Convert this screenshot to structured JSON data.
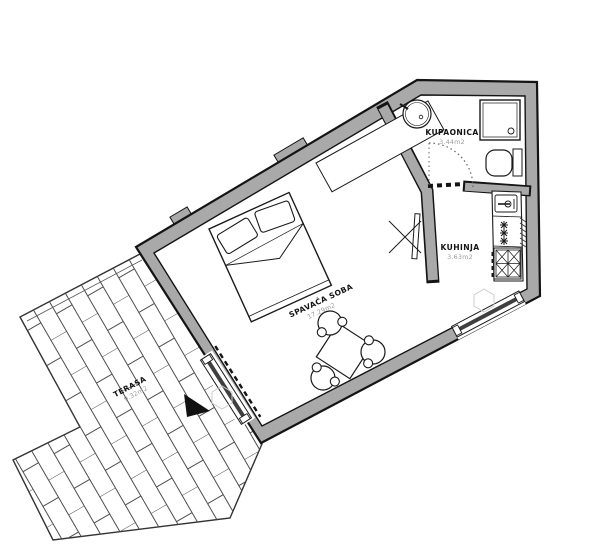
{
  "plan": {
    "rooms": [
      {
        "id": "kupaonica",
        "name": "KUPAONICA",
        "area": "3.44m2"
      },
      {
        "id": "kuhinja",
        "name": "KUHINJA",
        "area": "3.63m2"
      },
      {
        "id": "spavaca-soba",
        "name": "SPAVAĆA SOBA",
        "area": "17.29m2"
      },
      {
        "id": "terasa",
        "name": "TERASA",
        "area": "9.32m2"
      }
    ],
    "colors": {
      "wall_fill": "#a9a9a9",
      "outline": "#141414",
      "area_text": "#9b9b9b",
      "tile_line": "#4d4d4d",
      "glazing_dark": "#3f3f3f",
      "faint_symbol": "#cccccc"
    },
    "icons": [
      "bed-icon",
      "wardrobe-icon",
      "dining-table-icon",
      "chair-icon",
      "tv-icon",
      "washbasin-icon",
      "shower-icon",
      "toilet-icon",
      "kitchen-sink-icon",
      "freezer-stars-icon",
      "stove-icon",
      "radiator-hatch-icon",
      "window-icon",
      "sliding-door-icon",
      "door-swing-icon",
      "north-arrow-icon",
      "hexagon-light-icon"
    ]
  }
}
